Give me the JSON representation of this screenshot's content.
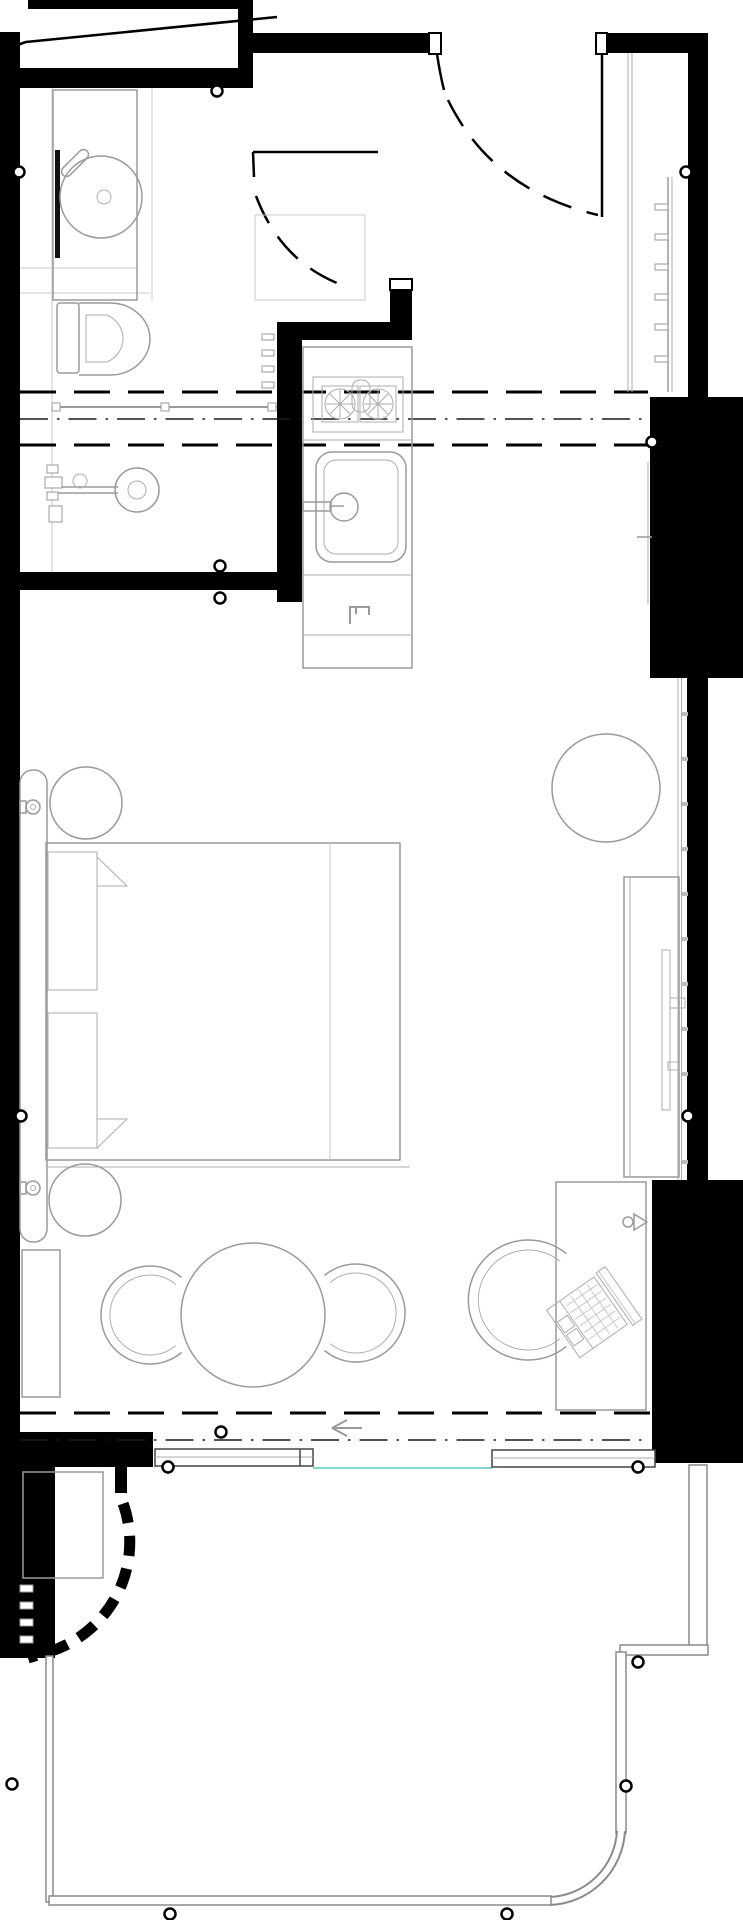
{
  "meta": {
    "kind": "architectural-floor-plan",
    "visible_text": "none"
  },
  "colors": {
    "background": "#ffffff",
    "wall_fill": "#000000",
    "furniture_line": "#9a9a9a",
    "light_line": "#c9c9c9",
    "railing_line": "#8a8a8a",
    "glass_accent_teal": "#7fd4cf",
    "marker_stroke": "#000000"
  },
  "labels": {
    "plan": "hotel-room-floor-plan",
    "walls": "structural-walls",
    "doors": "doors-and-swings",
    "bathroom": "bathroom",
    "kitchenette": "kitchenette",
    "wardrobe": "wardrobe-closet",
    "bedroom": "bedroom-area",
    "dining": "dining-area",
    "workspace": "desk-area",
    "balcony": "balcony",
    "markers": "reference-markers"
  },
  "fixtures": [
    "round-washbasin-on-vanity",
    "toilet",
    "walk-in-shower-with-rain-head",
    "shower-glass-partition-dashed",
    "curtain-track",
    "entry-door-open-leaf",
    "bathroom-door-leaf",
    "two-burner-cooktop",
    "kitchen-sink-with-faucet",
    "under-counter-appliance",
    "wardrobe-rail-with-hangers",
    "sliding-closet-track",
    "double-bed-with-two-pillows",
    "headboard-panel",
    "bedside-table-round-x2",
    "wall-sconce-x2",
    "lounge-armchair-round",
    "tv-sideboard",
    "television",
    "round-dining-table",
    "tub-chair-x2",
    "desk",
    "laptop",
    "desk-lamp",
    "desk-chair",
    "luggage-bench",
    "sliding-glass-door-panel",
    "direction-arrow",
    "balcony-ac-unit",
    "curved-dashed-parapet",
    "balcony-railing"
  ]
}
